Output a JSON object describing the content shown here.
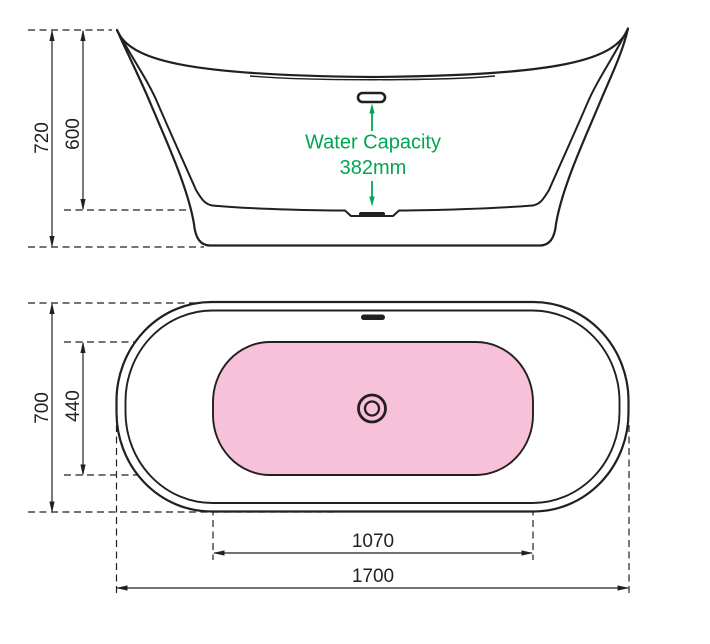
{
  "drawing_title": "Bathtub technical drawing",
  "colors": {
    "line": "#231F20",
    "annotation_green": "#00A651",
    "basin_pink": "#F6C1D9",
    "background": "#FFFFFF"
  },
  "side_view": {
    "overall_height": "720",
    "rim_to_basin_floor_height": "600",
    "water_capacity_label": "Water Capacity",
    "water_capacity_value": "382mm"
  },
  "plan_view": {
    "overall_width": "700",
    "basin_width": "440",
    "basin_length": "1070",
    "overall_length": "1700"
  }
}
